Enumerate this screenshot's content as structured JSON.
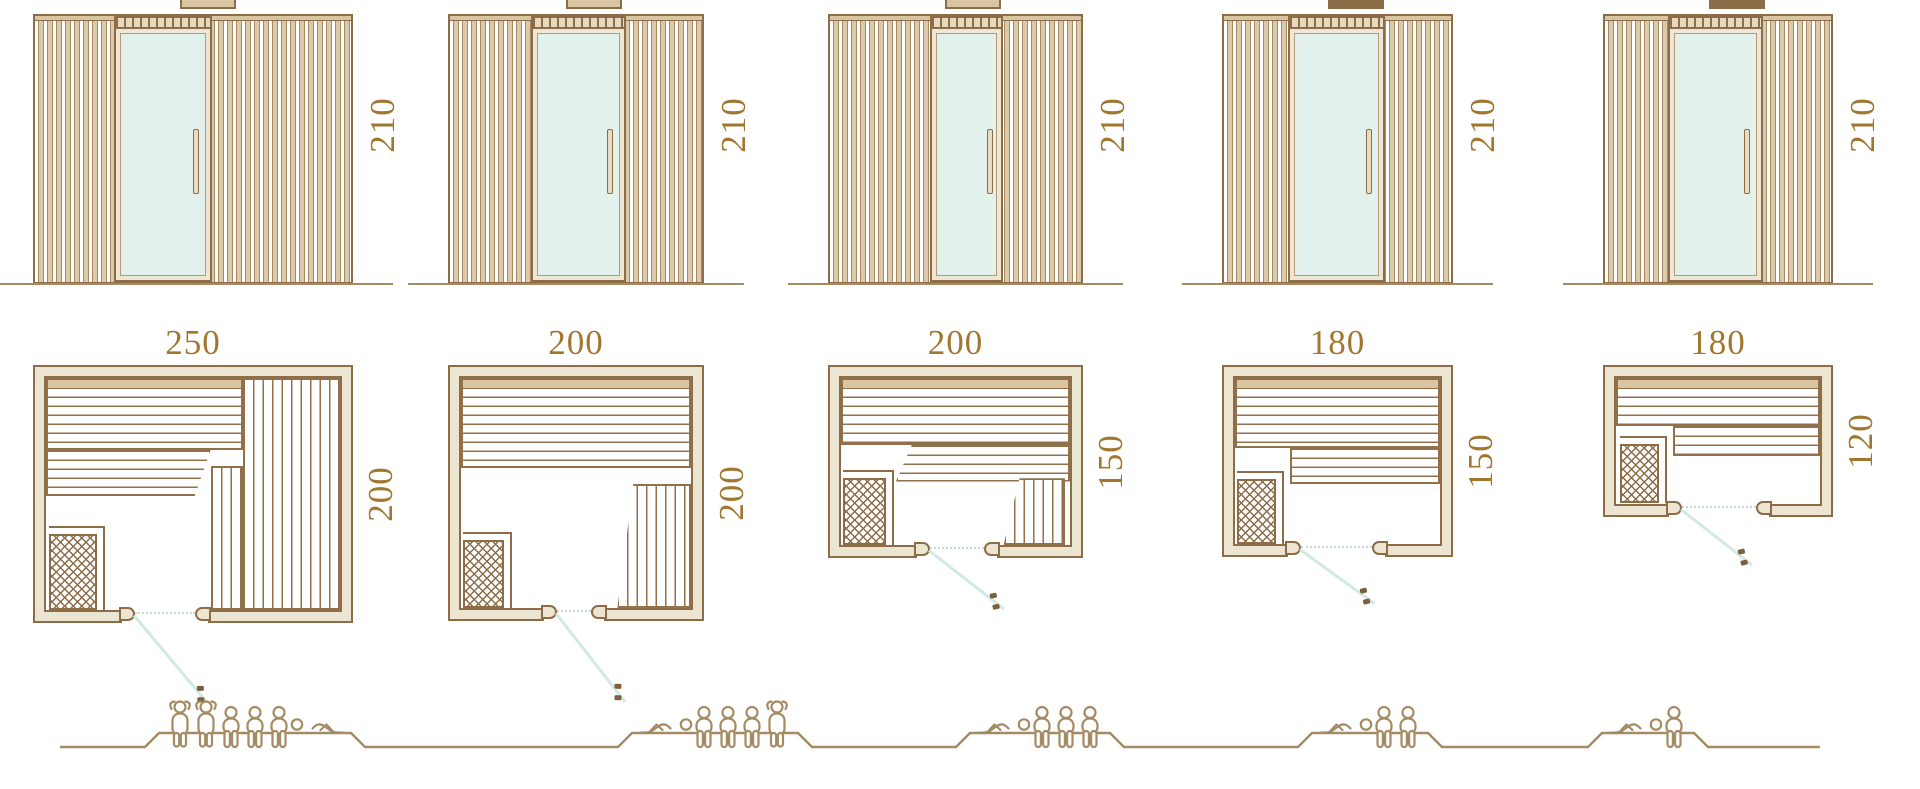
{
  "columns": [
    {
      "elevation_height_cm": "210",
      "plan_width_cm": "250",
      "plan_depth_cm": "200",
      "capacity": {
        "person_count": 6,
        "figures": [
          "standing",
          "standing",
          "sitting",
          "sitting",
          "sitting",
          "lying-head-left"
        ]
      }
    },
    {
      "elevation_height_cm": "210",
      "plan_width_cm": "200",
      "plan_depth_cm": "200",
      "capacity": {
        "person_count": 5,
        "figures": [
          "lying-head-right",
          "sitting",
          "sitting",
          "sitting",
          "standing"
        ]
      }
    },
    {
      "elevation_height_cm": "210",
      "plan_width_cm": "200",
      "plan_depth_cm": "150",
      "capacity": {
        "person_count": 4,
        "figures": [
          "lying-head-right",
          "sitting",
          "sitting",
          "sitting"
        ]
      }
    },
    {
      "elevation_height_cm": "210",
      "plan_width_cm": "180",
      "plan_depth_cm": "150",
      "capacity": {
        "person_count": 3,
        "figures": [
          "lying-head-right",
          "sitting",
          "sitting"
        ]
      }
    },
    {
      "elevation_height_cm": "210",
      "plan_width_cm": "180",
      "plan_depth_cm": "120",
      "capacity": {
        "person_count": 2,
        "figures": [
          "lying-head-right",
          "sitting"
        ]
      }
    }
  ],
  "colors": {
    "line_brown": "#8d6d48",
    "slat_tan": "#dcc9ab",
    "wall_beige": "#ece5d1",
    "glass_blue": "#e3f1ed",
    "door_swing_teal": "#cfe9e3",
    "dimension_text": "#a1762f",
    "figure_outline": "#a48b63"
  }
}
